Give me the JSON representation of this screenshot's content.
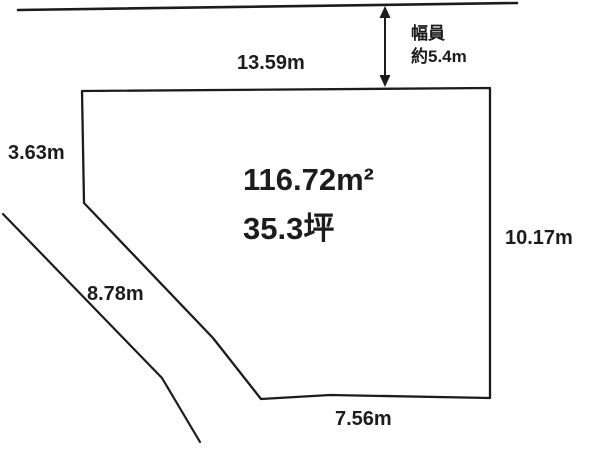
{
  "diagram": {
    "title": "land-plot-layout",
    "area": {
      "square_meters": "116.72m²",
      "tsubo": "35.3坪"
    },
    "dimensions": {
      "top_edge": "13.59m",
      "left_upper_edge": "3.63m",
      "left_lower_edge": "8.78m",
      "right_edge": "10.17m",
      "bottom_edge": "7.56m"
    },
    "road": {
      "width_label_line1": "幅員",
      "width_label_line2": "約5.4m"
    },
    "colors": {
      "line": "#1c1c1c",
      "background": "#ffffff"
    }
  }
}
